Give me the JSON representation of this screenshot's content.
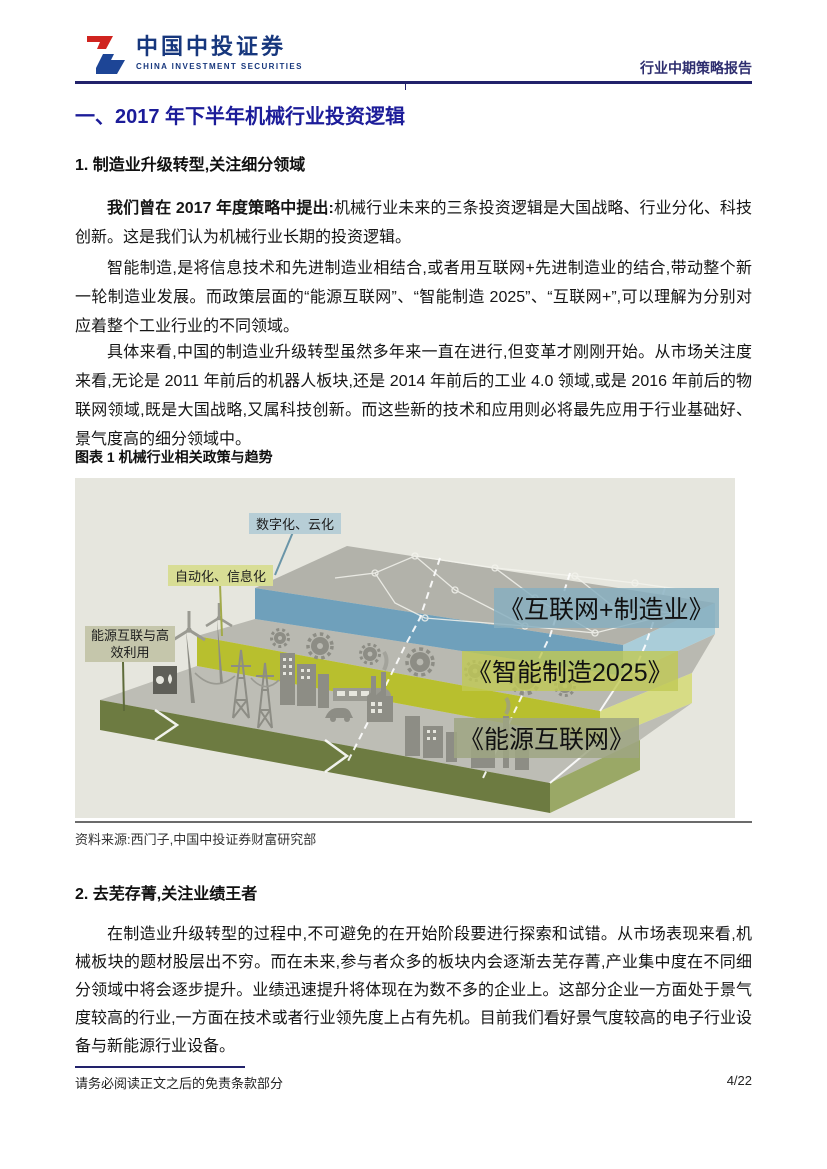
{
  "header": {
    "logo_cn": "中国中投证券",
    "logo_en": "CHINA  INVESTMENT  SECURITIES",
    "report_type": "行业中期策略报告"
  },
  "title": "一、2017 年下半年机械行业投资逻辑",
  "section1": {
    "heading": "1. 制造业升级转型,关注细分领域",
    "p1_lead": "我们曾在 2017 年度策略中提出:",
    "p1_text": "机械行业未来的三条投资逻辑是大国战略、行业分化、科技创新。这是我们认为机械行业长期的投资逻辑。",
    "p2": "智能制造,是将信息技术和先进制造业相结合,或者用互联网+先进制造业的结合,带动整个新一轮制造业发展。而政策层面的“能源互联网”、“智能制造 2025”、“互联网+”,可以理解为分别对应着整个工业行业的不同领域。",
    "p3": "具体来看,中国的制造业升级转型虽然多年来一直在进行,但变革才刚刚开始。从市场关注度来看,无论是 2011 年前后的机器人板块,还是 2014 年前后的工业 4.0 领域,或是 2016 年前后的物联网领域,既是大国战略,又属科技创新。而这些新的技术和应用则必将最先应用于行业基础好、景气度高的细分领域中。"
  },
  "figure": {
    "caption": "图表 1 机械行业相关政策与趋势",
    "source": "资料来源:西门子,中国中投证券财富研究部",
    "callout_digital": "数字化、云化",
    "callout_auto": "自动化、信息化",
    "callout_energy_line1": "能源互联与高",
    "callout_energy_line2": "效利用",
    "band_internet": "《互联网+制造业》",
    "band_smart": "《智能制造2025》",
    "band_energy": "《能源互联网》",
    "colors": {
      "background": "#e6e6de",
      "layer_internet": "#6fa0bb",
      "layer_smart": "#b8bf2e",
      "layer_energy": "#6d7b41"
    }
  },
  "section2": {
    "heading": "2. 去芜存菁,关注业绩王者",
    "p1": "在制造业升级转型的过程中,不可避免的在开始阶段要进行探索和试错。从市场表现来看,机械板块的题材股层出不穷。而在未来,参与者众多的板块内会逐渐去芜存菁,产业集中度在不同细分领域中将会逐步提升。业绩迅速提升将体现在为数不多的企业上。这部分企业一方面处于景气度较高的行业,一方面在技术或者行业领先度上占有先机。目前我们看好景气度较高的电子行业设备与新能源行业设备。"
  },
  "footer": {
    "disclaimer": "请务必阅读正文之后的免责条款部分",
    "page": "4/22"
  }
}
